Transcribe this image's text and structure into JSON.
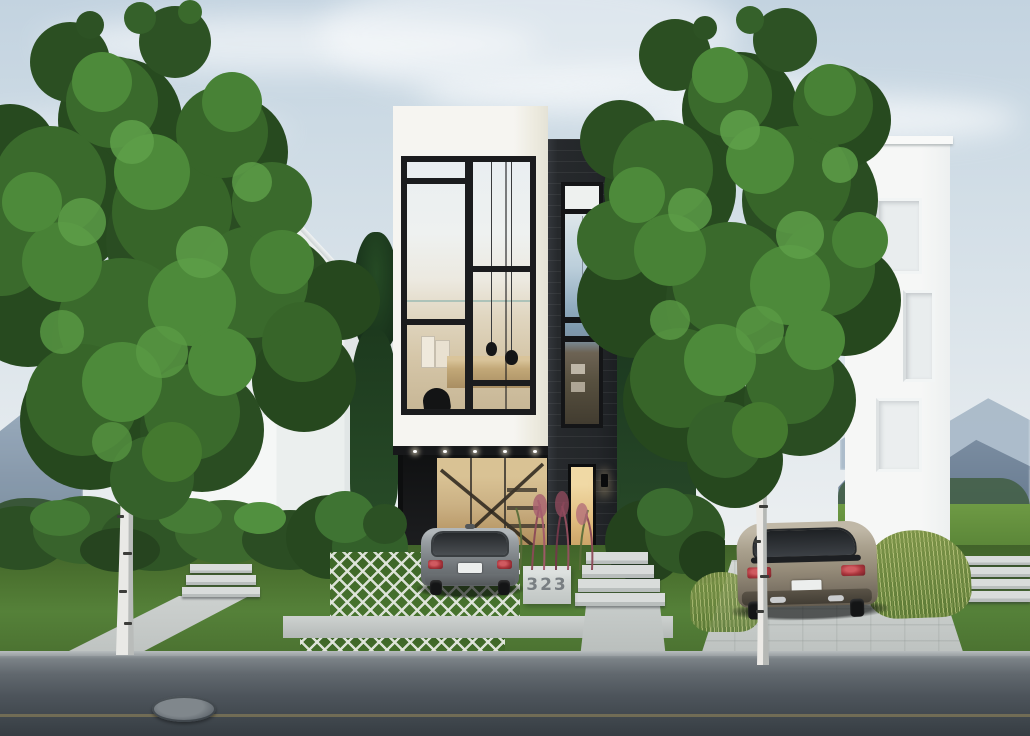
{
  "scene": {
    "description": "Photorealistic exterior rendering of a narrow modern infill house: white cantilevered volume with black Mondrian-style window grid, dark brick tower with tall window, carport with parked grey hatchback, warm-lit entry, concrete steps and address plinth, flanked by birch trees, hedges and two white neighbour houses, overcast sky with distant mountains and green field, asphalt street with manhole in front",
    "house_number": "323",
    "time_of_day": "soft overcast daylight",
    "inventory": [
      "sky",
      "clouds",
      "distant-mountains",
      "treeline",
      "green-field",
      "left-gabled-house",
      "right-flat-roof-house",
      "center-modern-house",
      "mondrian-window-grid",
      "pendant-lamps",
      "egg-chair",
      "artwork",
      "black-clad-tower",
      "tower-window",
      "carport",
      "stair-glass-wall",
      "entry-door",
      "wall-sconce",
      "soffit-downlights",
      "concrete-steps",
      "address-plinth",
      "ornamental-pink-grasses",
      "hedges",
      "bushes",
      "conifers",
      "birch-tree-left",
      "birch-tree-right",
      "grey-hatchback-car",
      "beige-hatchback-car",
      "grass-paver-driveway",
      "concrete-driveway",
      "left-walkway",
      "lawn",
      "tall-grasses",
      "asphalt-street",
      "yellow-road-line",
      "manhole-cover",
      "curb"
    ]
  },
  "palette": {
    "sky_top": "#c3d3e0",
    "sky_horizon": "#edf0f1",
    "facade_white": "#f4f3ef",
    "cladding_black": "#26292c",
    "window_frame": "#1b1c1e",
    "interior_warm": "#d5c6a8",
    "foliage_dark": "#274a1f",
    "foliage_mid": "#3a6a2c",
    "foliage_light": "#4d8a3a",
    "lawn_green": "#4d7530",
    "concrete": "#c9cecc",
    "asphalt": "#474e55",
    "car_grey": "#84898d",
    "car_beige": "#a79d8a",
    "taillight_red": "#a8343b",
    "address_text": "#70767a",
    "road_line_yellow": "#b9a35e",
    "mountain_blue": "#76889c",
    "field_green": "#6e9a44"
  }
}
